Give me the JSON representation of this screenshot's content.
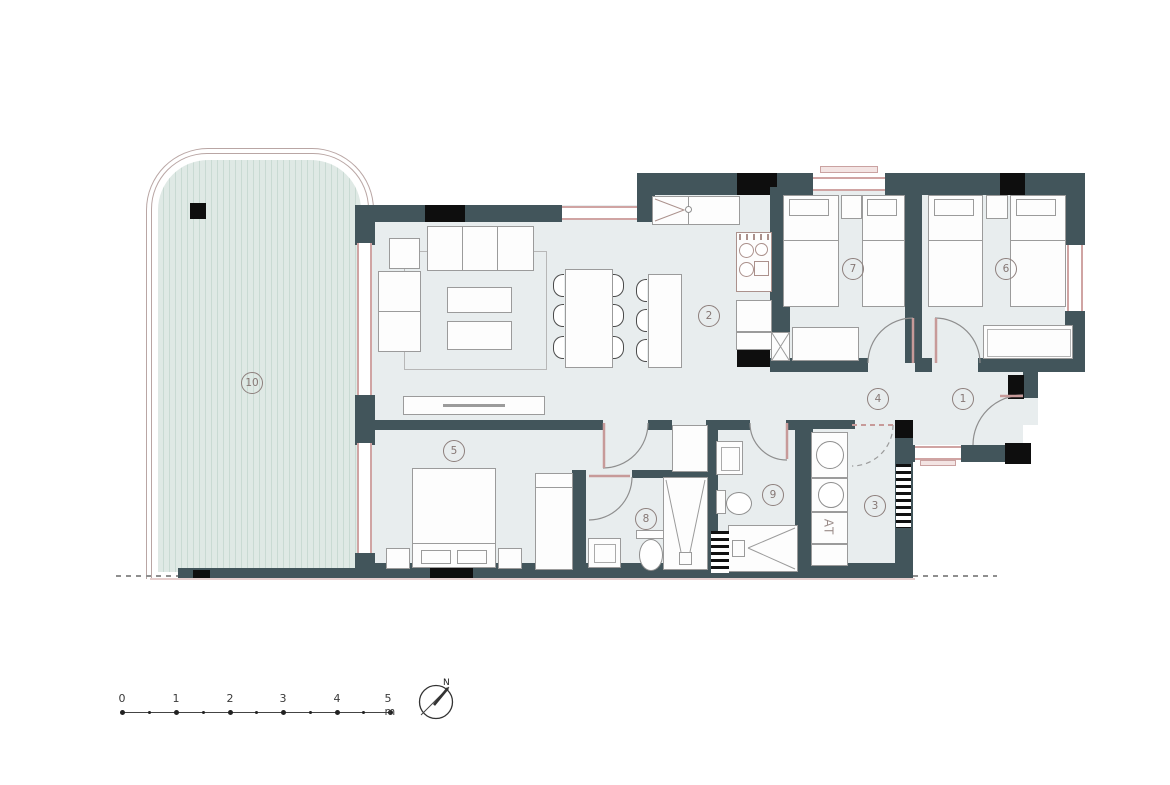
{
  "plan": {
    "rooms": {
      "r1": {
        "label": "1"
      },
      "r2": {
        "label": "2"
      },
      "r3": {
        "label": "3"
      },
      "r4": {
        "label": "4"
      },
      "r5": {
        "label": "5"
      },
      "r6": {
        "label": "6"
      },
      "r7": {
        "label": "7"
      },
      "r8": {
        "label": "8"
      },
      "r9": {
        "label": "9"
      },
      "r10": {
        "label": "10"
      }
    },
    "equipment": {
      "water_heater_label": "AT"
    }
  },
  "scale_bar": {
    "ticks": [
      "0",
      "1",
      "2",
      "3",
      "4",
      "5 m"
    ]
  },
  "compass": {
    "north_label": "N"
  },
  "colors": {
    "wall": "#42555b",
    "column": "#0e0e0e",
    "floor": "#e8edee",
    "terrace_stripe": "#c9dad3",
    "frame_pink": "#d0a4a3",
    "furniture_line": "#9b9b9b"
  }
}
